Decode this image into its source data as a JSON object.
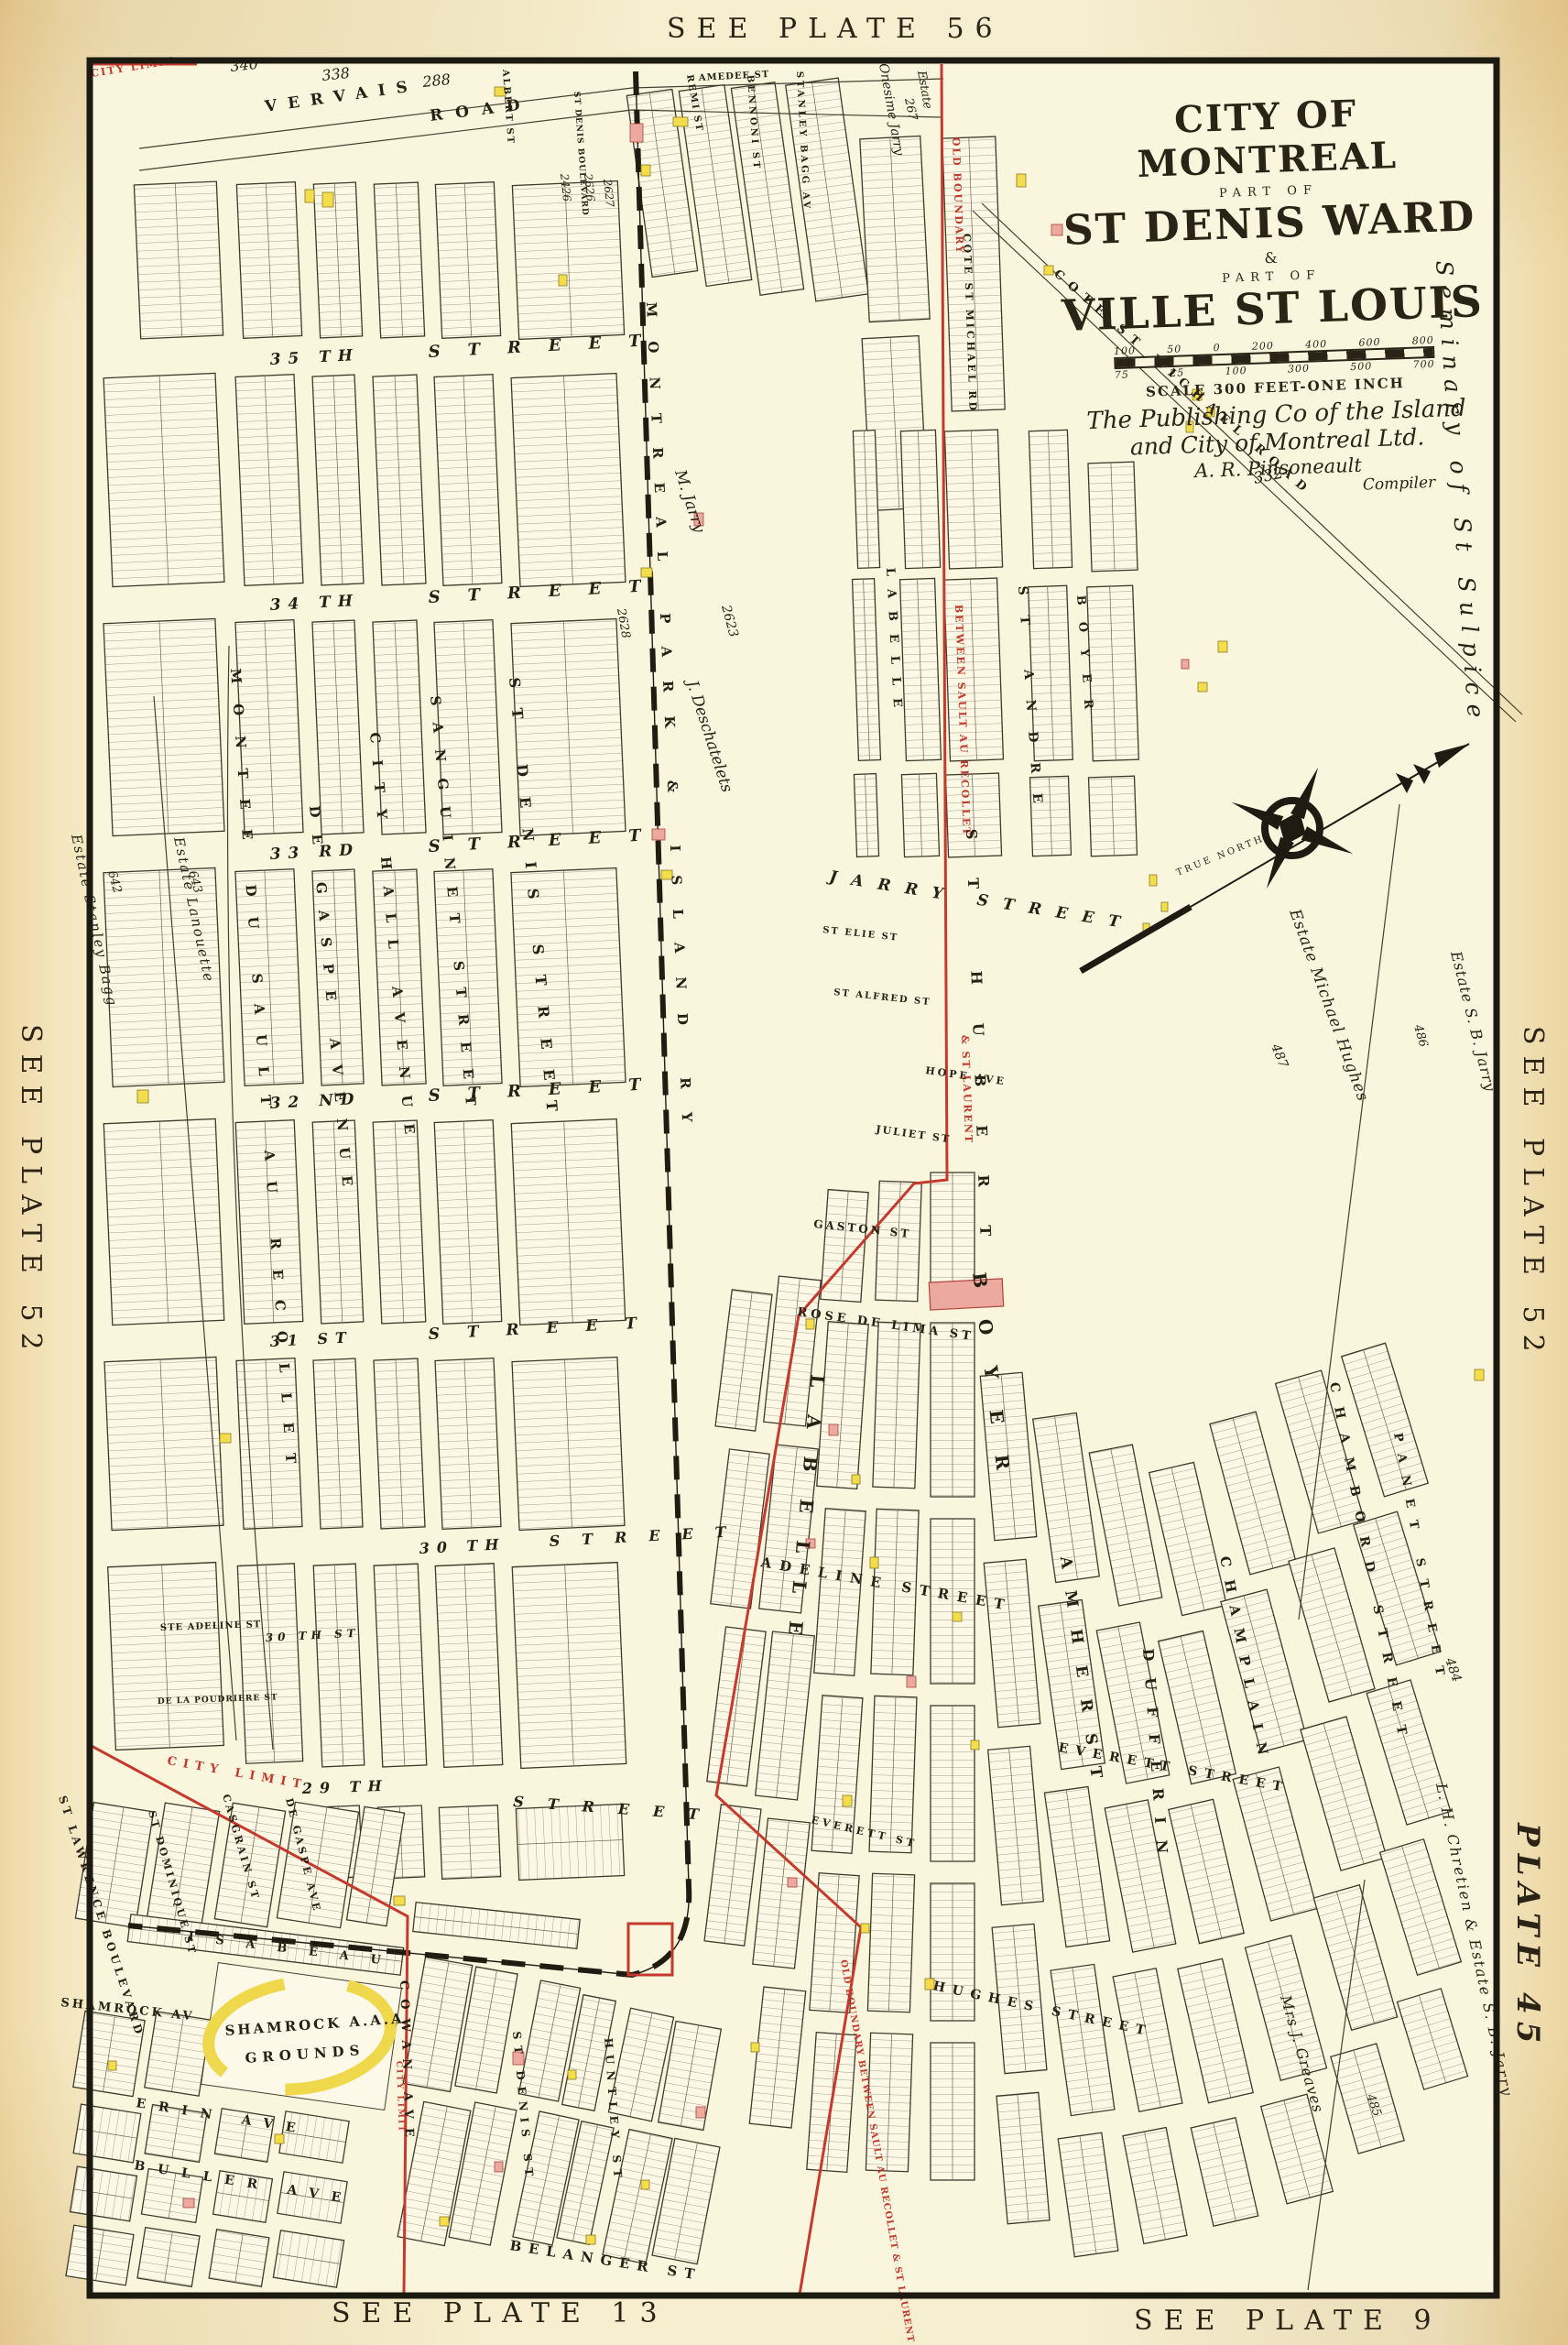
{
  "margin": {
    "top": "SEE PLATE 56",
    "left": "SEE PLATE 52",
    "right": "SEE PLATE 52",
    "plate": "PLATE 45",
    "bottom_left": "SEE PLATE 13",
    "bottom_right": "SEE PLATE 9"
  },
  "title": {
    "city": "CITY OF MONTREAL",
    "part_of_1": "PART OF",
    "ward": "ST DENIS WARD",
    "amp": "&",
    "part_of_2": "PART OF",
    "ville": "VILLE ST LOUIS",
    "scale_label": "SCALE 300 FEET-ONE INCH",
    "publisher_line1": "The Publishing Co of the Island",
    "publisher_line2": "and City of Montreal Ltd.",
    "signature": "A. R. Pinsoneault",
    "compiler": "Compiler",
    "scale_top": [
      "100",
      "50",
      "0",
      "200",
      "400",
      "600",
      "800"
    ],
    "scale_bottom": [
      "75",
      "25",
      "100",
      "300",
      "500",
      "700"
    ]
  },
  "streets": {
    "vervais_1": "VERVAIS",
    "vervais_2": "ROAD",
    "s35a": "35 TH",
    "s35b": "STREET",
    "s34a": "34 TH",
    "s34b": "STREET",
    "s33a": "33 RD",
    "s33b": "STREET",
    "s32a": "32 ND",
    "s32b": "STREET",
    "s31a": "31 ST",
    "s31b": "STREET",
    "s30a": "30 TH",
    "s30b": "STREET",
    "s29a": "29 TH",
    "s29b": "STREET",
    "s30_small": "30 TH ST",
    "ste_adeline": "STE ADELINE ST",
    "poudriere": "DE LA POUDRIERE ST",
    "montee": "MONTEE DU SAULT AU RECOLLET",
    "de_gaspe": "DE GASPE AVENUE",
    "city_hall": "CITY HALL AVENUE",
    "sanguinet": "SANGUINET STREET",
    "st_denis": "ST DENIS STREET",
    "railway": "MONTREAL PARK & ISLAND RY",
    "labelle_upper": "LABELLE",
    "st_andre": "ST ANDRE",
    "boyer_upper": "BOYER",
    "st_hubert": "ST HUBERT",
    "labelle": "LABELLE",
    "boyer": "BOYER",
    "amherst": "AMHERST",
    "dufferin": "DUFFERIN",
    "champlain": "CHAMPLAIN",
    "chambord": "CHAMBORD STREET",
    "panet": "PANET STREET",
    "jarry": "JARRY STREET",
    "st_elie": "ST ELIE ST",
    "st_alfred": "ST ALFRED ST",
    "hope": "HOPE AVE",
    "juliet": "JULIET ST",
    "gaston": "GASTON ST",
    "rose_de_lima": "ROSE DE LIMA ST",
    "adeline": "ADELINE STREET",
    "everett": "EVERETT STREET",
    "everett_small": "EVERETT ST",
    "hughes": "HUGHES STREET",
    "belanger": "BELANGER ST",
    "st_lawrence": "ST LAWRENCE BOULEVARD",
    "st_dominique": "ST DOMINIQUE ST",
    "casgrain": "CASGRAIN ST",
    "de_gaspe_ave": "DE GASPE AVE",
    "cowan": "COWAN AVE",
    "isabeau": "ISABEAU",
    "shamrock_av": "SHAMROCK AV",
    "erin": "ERIN AVE",
    "buller": "BULLER AVE",
    "st_denis_s": "ST DENIS ST",
    "huntley": "HUNTLEY ST",
    "remi": "REMI ST",
    "amedee": "AMEDEE ST",
    "bennoni": "BENNONI ST",
    "stanley_bagg": "STANLEY BAGG AV",
    "albert": "ALBERT ST",
    "st_denis_blvd": "ST DENIS BOULEVARD",
    "cote_michael_road": "COTE ST MICHAEL ROAD",
    "cote_michael_rd": "COTE ST MICHAEL RD"
  },
  "boundaries": {
    "city_limit": "CITY LIMIT",
    "old_boundary": "OLD BOUNDARY",
    "between": "BETWEEN SAULT AU RECOLLET",
    "st_laurent": "& ST LAURENT",
    "old_boundary_long": "OLD BOUNDARY BETWEEN SAULT AU RECOLLET & ST LAURENT"
  },
  "labels": {
    "true_north": "TRUE NORTH",
    "shamrock_1": "SHAMROCK A.A.A.",
    "shamrock_2": "GROUNDS",
    "seminary": "Seminary of St Sulpice",
    "estate_word": "Estate",
    "estate_onesime": "Onesime Jarry",
    "estate_stanley_bagg": "Estate Stanley Bagg",
    "estate_lanouette": "Estate Lanouette",
    "estate_hughes": "Estate Michael Hughes",
    "estate_sb_jarry": "Estate S. B. Jarry",
    "chretien": "L. H. Chretien & Estate S. B. Jarry",
    "greaves": "Mrs J. Greaves",
    "m_jarry": "M. Jarry",
    "deschatelets": "J. Deschatelets"
  },
  "numbers": {
    "n340": "340",
    "n338": "338",
    "n288": "288",
    "n267": "267",
    "n332": "332",
    "n2426": "2426",
    "n2626": "2626",
    "n2627": "2627",
    "n2623": "2623",
    "n2628": "2628",
    "n642": "642",
    "n643": "643",
    "n484": "484",
    "n485": "485",
    "n486": "486",
    "n487": "487"
  }
}
